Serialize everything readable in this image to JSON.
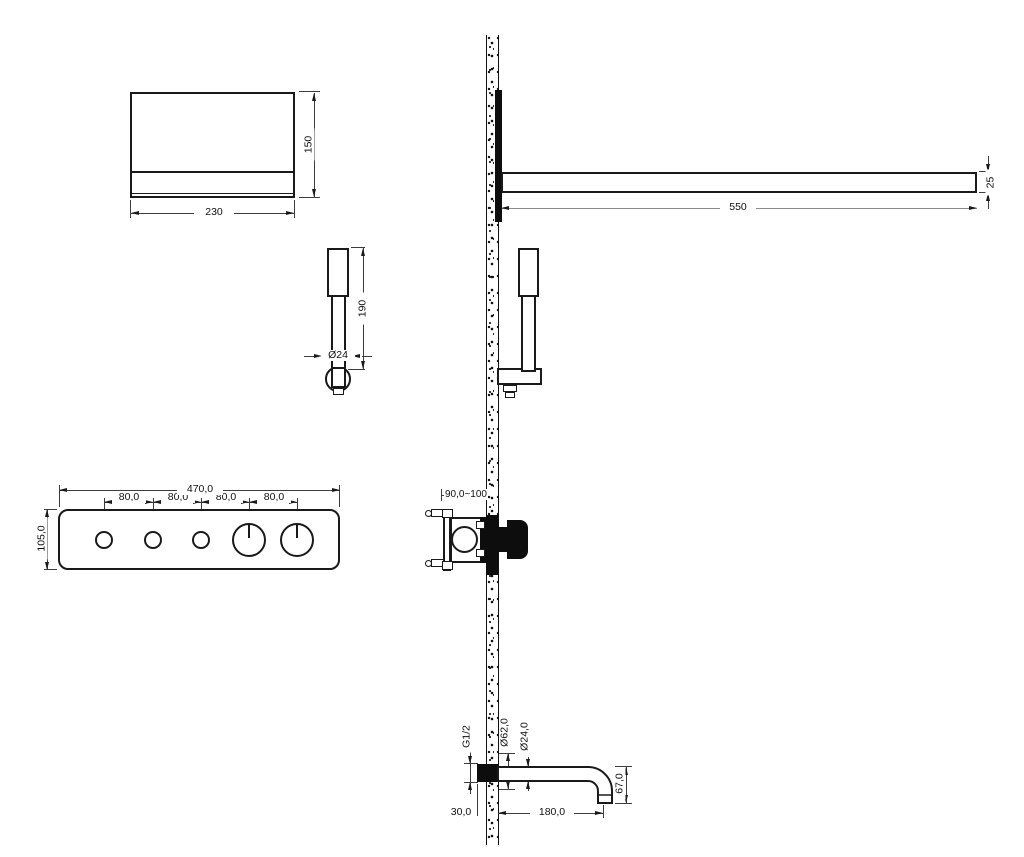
{
  "drawing_labels": {
    "overhead_shower": {
      "width": "230",
      "height": "150"
    },
    "shower_arm": {
      "length": "550",
      "thickness": "25"
    },
    "hand_shower": {
      "length": "190",
      "diameter": "Ø24"
    },
    "control_panel": {
      "width": "470,0",
      "height": "105,0",
      "spacing": [
        "80,0",
        "80,0",
        "80,0",
        "80,0"
      ]
    },
    "concealed_valve": {
      "install_depth": "90,0~100"
    },
    "spout": {
      "thread": "G1/2",
      "flange_diameter": "Ø62,0",
      "pipe_diameter": "Ø24,0",
      "drop_height": "67,0",
      "wall_inset": "30,0",
      "reach": "180,0"
    }
  },
  "colors": {
    "line": "#1a1a1a",
    "dimension": "#3d3d3d",
    "background": "#ffffff"
  }
}
